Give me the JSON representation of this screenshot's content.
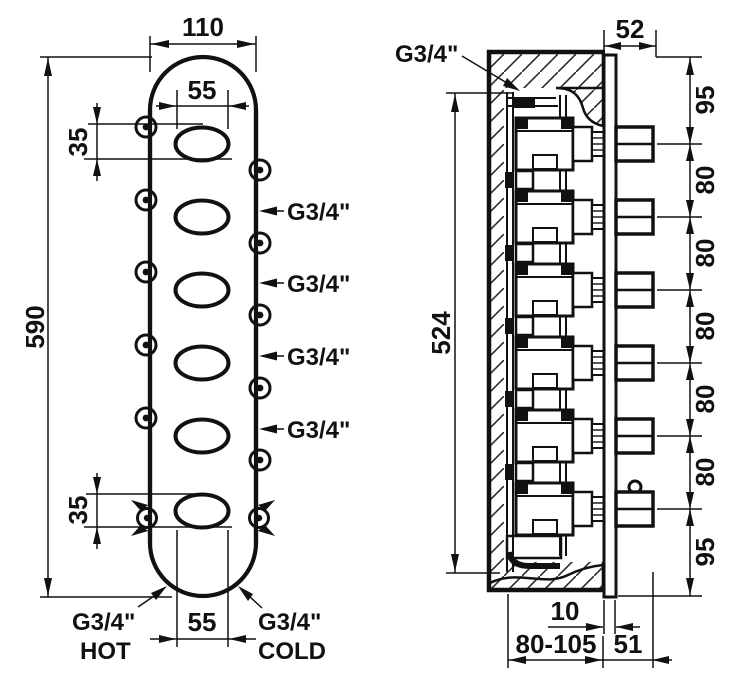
{
  "front_view": {
    "dim_width": "110",
    "dim_oval_width_top": "55",
    "dim_oval_height_top": "35",
    "dim_height": "590",
    "dim_oval_height_bottom": "35",
    "dim_oval_width_bottom": "55",
    "side_ports": [
      "G3/4\"",
      "G3/4\"",
      "G3/4\"",
      "G3/4\""
    ],
    "hot_size": "G3/4\"",
    "hot_label": "HOT",
    "cold_size": "G3/4\"",
    "cold_label": "COLD"
  },
  "side_view": {
    "inlet_label": "G3/4\"",
    "dim_front_depth": "52",
    "dim_body_height": "524",
    "dim_spacing": [
      "95",
      "80",
      "80",
      "80",
      "80",
      "80",
      "95"
    ],
    "dim_plate_thickness": "10",
    "dim_rough_in_depth": "80-105",
    "dim_knob_protrusion": "51"
  }
}
